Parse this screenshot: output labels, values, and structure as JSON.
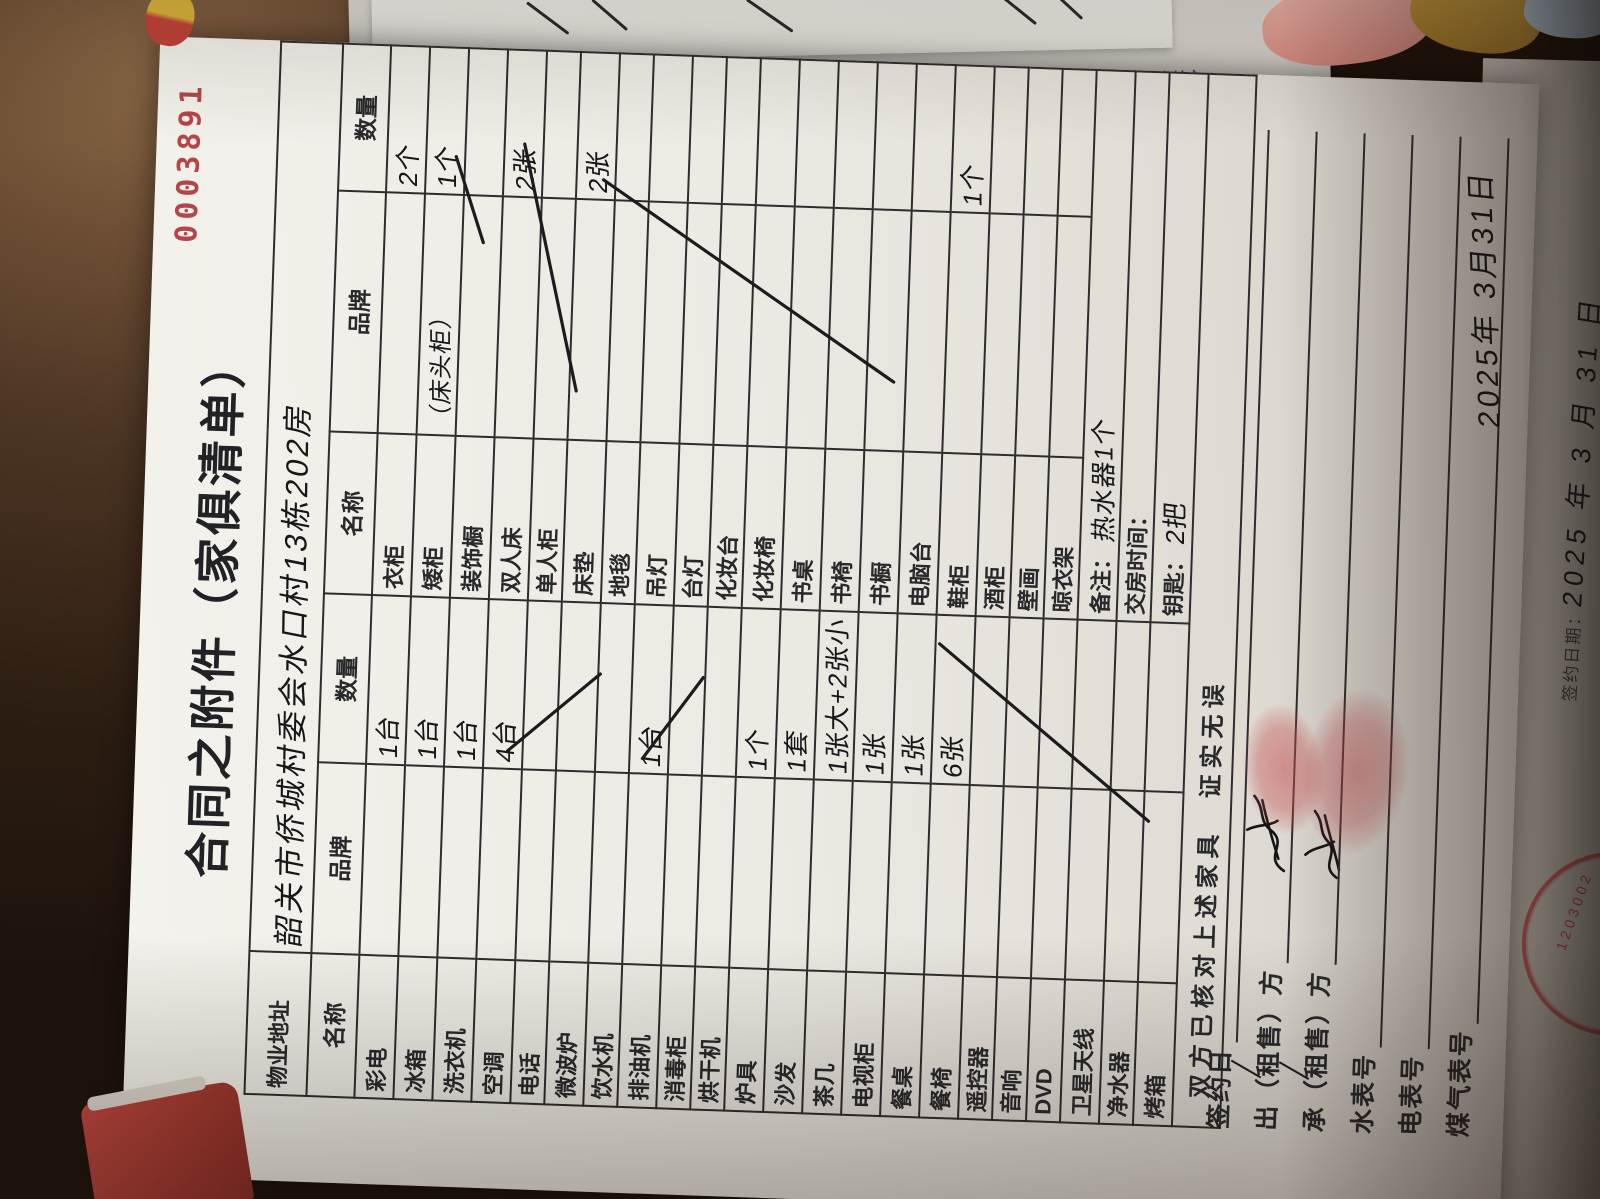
{
  "background": {
    "receipt_copies": [
      "联：公司联（白）",
      "第二联：业主联（红）",
      "第三联：客户联（黄）"
    ],
    "side_sheet": {
      "label": "签约日期：",
      "date": "2025 年 3 月 31 日",
      "seal_digits": "1203002"
    }
  },
  "document": {
    "serial": "0003891",
    "title": "合同之附件（家俱清单）",
    "property_row": {
      "label": "物业地址",
      "value": "韶关市侨城村委会水口村13栋202房"
    },
    "headers": [
      "名称",
      "品牌",
      "数量",
      "名称",
      "品牌",
      "数量"
    ],
    "rows": [
      {
        "name1": "彩电",
        "brand1": "",
        "qty1": "1台",
        "name2": "衣柜",
        "brand2": "",
        "qty2": "2个"
      },
      {
        "name1": "冰箱",
        "brand1": "",
        "qty1": "1台",
        "name2": "矮柜",
        "brand2": "（床头柜）",
        "qty2": "1个"
      },
      {
        "name1": "洗衣机",
        "brand1": "",
        "qty1": "1台",
        "name2": "装饰橱",
        "brand2": "",
        "qty2": ""
      },
      {
        "name1": "空调",
        "brand1": "",
        "qty1": "4台",
        "name2": "双人床",
        "brand2": "",
        "qty2": "2张"
      },
      {
        "name1": "电话",
        "brand1": "",
        "qty1": "",
        "name2": "单人柜",
        "brand2": "",
        "qty2": ""
      },
      {
        "name1": "微波炉",
        "brand1": "",
        "qty1": "",
        "name2": "床垫",
        "brand2": "",
        "qty2": "2张"
      },
      {
        "name1": "饮水机",
        "brand1": "",
        "qty1": "",
        "name2": "地毯",
        "brand2": "",
        "qty2": ""
      },
      {
        "name1": "排油机",
        "brand1": "",
        "qty1": "1台",
        "name2": "吊灯",
        "brand2": "",
        "qty2": ""
      },
      {
        "name1": "消毒柜",
        "brand1": "",
        "qty1": "",
        "name2": "台灯",
        "brand2": "",
        "qty2": ""
      },
      {
        "name1": "烘干机",
        "brand1": "",
        "qty1": "",
        "name2": "化妆台",
        "brand2": "",
        "qty2": ""
      },
      {
        "name1": "炉具",
        "brand1": "",
        "qty1": "1个",
        "name2": "化妆椅",
        "brand2": "",
        "qty2": ""
      },
      {
        "name1": "沙发",
        "brand1": "",
        "qty1": "1套",
        "name2": "书桌",
        "brand2": "",
        "qty2": ""
      },
      {
        "name1": "茶几",
        "brand1": "",
        "qty1": "1张大+2张小",
        "name2": "书椅",
        "brand2": "",
        "qty2": ""
      },
      {
        "name1": "电视柜",
        "brand1": "",
        "qty1": "1张",
        "name2": "书橱",
        "brand2": "",
        "qty2": ""
      },
      {
        "name1": "餐桌",
        "brand1": "",
        "qty1": "1张",
        "name2": "电脑台",
        "brand2": "",
        "qty2": ""
      },
      {
        "name1": "餐椅",
        "brand1": "",
        "qty1": "6张",
        "name2": "鞋柜",
        "brand2": "",
        "qty2": "1个"
      },
      {
        "name1": "遥控器",
        "brand1": "",
        "qty1": "",
        "name2": "酒柜",
        "brand2": "",
        "qty2": ""
      },
      {
        "name1": "音响",
        "brand1": "",
        "qty1": "",
        "name2": "壁画",
        "brand2": "",
        "qty2": ""
      },
      {
        "name1": "DVD",
        "brand1": "",
        "qty1": "",
        "name2": "晾衣架",
        "brand2": "",
        "qty2": ""
      },
      {
        "name1": "卫星天线",
        "qty1": "",
        "merged": true,
        "label2": "备注：",
        "value2": "热水器1个"
      },
      {
        "name1": "净水器",
        "qty1": "",
        "merged": true,
        "label2": "交房时间：",
        "value2": ""
      },
      {
        "name1": "烤箱",
        "qty1": "",
        "merged": true,
        "label2": "钥匙：",
        "value2": "2把"
      }
    ],
    "strike_marks": [
      "电话/微波炉/饮水机-数量",
      "消毒柜/烘干机-数量",
      "音响~烤箱-品牌数量",
      "装饰橱-数量",
      "单人柜-品牌数量",
      "地毯~化妆椅-品牌数量"
    ],
    "confirm_text": "双方已核对上述家具　证实无误",
    "signature": {
      "labels": [
        {
          "label": "签约日",
          "strike": false
        },
        {
          "label": "出（租售）方",
          "strike": true
        },
        {
          "label": "承（租售）方",
          "strike": true
        },
        {
          "label": "水表号",
          "strike": false
        },
        {
          "label": "电表号",
          "strike": false
        },
        {
          "label": "煤气表号",
          "strike": false
        }
      ],
      "date": "2025年 3月31日"
    }
  }
}
